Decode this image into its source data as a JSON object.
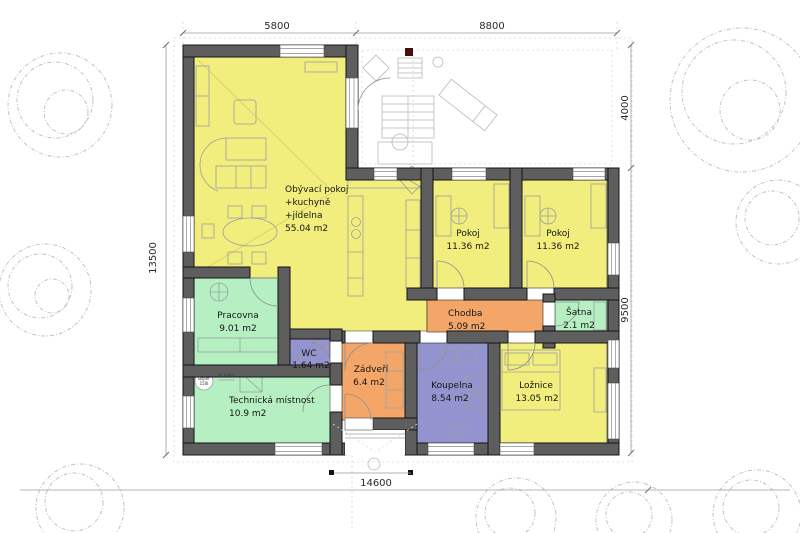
{
  "title": "Floor plan of single-storey house",
  "rooms": [
    {
      "id": "obyvaci-pokoj",
      "name1": "Obývací pokoj",
      "name2": "+kuchyně",
      "name3": "+jídelna",
      "area": "55.04 m2"
    },
    {
      "id": "pokoj-1",
      "name": "Pokoj",
      "area": "11.36 m2"
    },
    {
      "id": "pokoj-2",
      "name": "Pokoj",
      "area": "11.36 m2"
    },
    {
      "id": "chodba",
      "name": "Chodba",
      "area": "5.09 m2"
    },
    {
      "id": "satna",
      "name": "Šatna",
      "area": "2.1 m2"
    },
    {
      "id": "pracovna",
      "name": "Pracovna",
      "area": "9.01 m2"
    },
    {
      "id": "wc",
      "name": "WC",
      "area": "1.64 m2"
    },
    {
      "id": "zadveri",
      "name": "Zádveří",
      "area": "6.4 m2"
    },
    {
      "id": "koupelna",
      "name": "Koupelna",
      "area": "8.54 m2"
    },
    {
      "id": "loznice",
      "name": "Ložnice",
      "area": "13.05 m2"
    },
    {
      "id": "technicka-mistnost",
      "name": "Technická místnost",
      "area": "10.9 m2"
    }
  ],
  "dimensions": {
    "top_left": "5800",
    "top_right": "8800",
    "right_upper": "4000",
    "right_lower": "9500",
    "left": "13500",
    "bottom": "14600"
  },
  "equipment": {
    "boiler_line1": "Bojler",
    "boiler_line2": "150l",
    "electric_boiler": "El. kotel"
  },
  "colors": {
    "room_yellow": "#f2ee7d",
    "room_green": "#b5efc2",
    "room_orange": "#f4a668",
    "room_purple": "#9394cf",
    "wall_gray": "#5e5e5e",
    "accent_dark_red": "#4a0d0d"
  }
}
